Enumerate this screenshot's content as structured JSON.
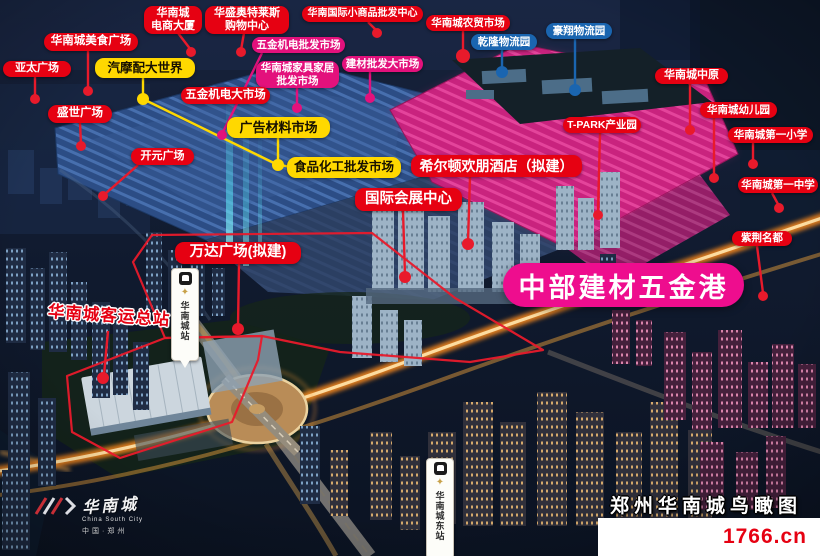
{
  "meta": {
    "title": "郑州华南城鸟瞰图",
    "site": "1766.cn"
  },
  "banner": {
    "text": "中部建材五金港"
  },
  "logo": {
    "name": "华南城",
    "english": "China South City",
    "location": "中国·郑州"
  },
  "icons": {
    "compass": "✦"
  },
  "palette": {
    "red": "#e60112",
    "line_red": "#e81a2b",
    "yellow": "#ffd800",
    "blue": "#1a65b0",
    "pink": "#e3117c",
    "magenta": "#ee0d8e"
  },
  "map": {
    "labels": [
      {
        "id": "ecommerce-tower",
        "lines": [
          "华南城",
          "电商大厦"
        ],
        "color": "red",
        "x": 144,
        "y": 6,
        "w": 58,
        "h": 28,
        "fs": 11,
        "line": "178,33 191,50",
        "dot": [
          191,
          52,
          5
        ]
      },
      {
        "id": "huasheng-outlets",
        "lines": [
          "华盛奥特莱斯",
          "购物中心"
        ],
        "color": "red",
        "x": 205,
        "y": 6,
        "w": 84,
        "h": 28,
        "fs": 11,
        "line": "244,33 241,50",
        "dot": [
          241,
          52,
          5
        ]
      },
      {
        "id": "small-commodity-center",
        "lines": [
          "华南国际小商品批发中心"
        ],
        "color": "red",
        "x": 302,
        "y": 6,
        "w": 121,
        "h": 16,
        "fs": 10,
        "line": "368,22 377,31",
        "dot": [
          377,
          33,
          5
        ]
      },
      {
        "id": "farm-market",
        "lines": [
          "华南城农贸市场"
        ],
        "color": "red",
        "x": 426,
        "y": 15,
        "w": 84,
        "h": 16,
        "fs": 10.5,
        "line": "463,31 463,53",
        "dot": [
          463,
          56,
          7
        ]
      },
      {
        "id": "haoxiang-logistics",
        "lines": [
          "豪翔物流园"
        ],
        "color": "blue",
        "x": 546,
        "y": 23,
        "w": 66,
        "h": 16,
        "fs": 10.5,
        "line": "575,39 575,87",
        "dot": [
          575,
          90,
          6
        ]
      },
      {
        "id": "food-plaza",
        "lines": [
          "华南城美食广场"
        ],
        "color": "red",
        "x": 44,
        "y": 33,
        "w": 94,
        "h": 18,
        "fs": 11.5,
        "line": "88,51 88,89",
        "dot": [
          88,
          91,
          5
        ]
      },
      {
        "id": "qianlong-logistics",
        "lines": [
          "乾隆物流园"
        ],
        "color": "blue",
        "x": 471,
        "y": 34,
        "w": 66,
        "h": 16,
        "fs": 10.5,
        "line": "502,50 502,69",
        "dot": [
          502,
          72,
          6
        ]
      },
      {
        "id": "hardware-wholesale",
        "lines": [
          "五金机电批发市场"
        ],
        "color": "pink",
        "x": 252,
        "y": 37,
        "w": 93,
        "h": 16,
        "fs": 10.5,
        "line": "262,53 223,132",
        "dot": [
          222,
          135,
          5
        ]
      },
      {
        "id": "yatai-plaza",
        "lines": [
          "亚太广场"
        ],
        "color": "red",
        "x": 3,
        "y": 61,
        "w": 68,
        "h": 16,
        "fs": 11,
        "line": "35,77 35,97",
        "dot": [
          35,
          99,
          5
        ]
      },
      {
        "id": "auto-parts-world",
        "lines": [
          "汽摩配大世界"
        ],
        "color": "yellow",
        "x": 95,
        "y": 58,
        "w": 100,
        "h": 20,
        "fs": 12.5,
        "line": "143,78 143,97",
        "dot": [
          143,
          99,
          6
        ]
      },
      {
        "id": "building-materials-market",
        "lines": [
          "建材批发大市场"
        ],
        "color": "pink",
        "x": 342,
        "y": 56,
        "w": 81,
        "h": 16,
        "fs": 10.5,
        "line": "370,72 370,96",
        "dot": [
          370,
          98,
          5
        ]
      },
      {
        "id": "furniture-market",
        "lines": [
          "华南城家具家居",
          "批发市场"
        ],
        "color": "pink",
        "x": 256,
        "y": 61,
        "w": 83,
        "h": 27,
        "fs": 10.5,
        "line": "297,88 297,106",
        "dot": [
          297,
          108,
          5
        ]
      },
      {
        "id": "csc-zhongyuan",
        "lines": [
          "华南城中原"
        ],
        "color": "red",
        "x": 655,
        "y": 68,
        "w": 73,
        "h": 16,
        "fs": 11,
        "line": "690,84 690,128",
        "dot": [
          690,
          130,
          5
        ]
      },
      {
        "id": "hardware-big-market",
        "lines": [
          "五金机电大市场"
        ],
        "color": "red",
        "x": 181,
        "y": 87,
        "w": 89,
        "h": 17,
        "fs": 11.5
      },
      {
        "id": "shengshi-plaza",
        "lines": [
          "盛世广场"
        ],
        "color": "red",
        "x": 48,
        "y": 105,
        "w": 64,
        "h": 18,
        "fs": 11.5,
        "line": "80,123 81,144",
        "dot": [
          81,
          146,
          5
        ]
      },
      {
        "id": "kindergarten",
        "lines": [
          "华南城幼儿园"
        ],
        "color": "red",
        "x": 700,
        "y": 102,
        "w": 77,
        "h": 16,
        "fs": 10.5,
        "line": "714,118 714,176",
        "dot": [
          714,
          178,
          5
        ]
      },
      {
        "id": "ad-materials-market",
        "lines": [
          "广告材料市场"
        ],
        "color": "yellow",
        "x": 227,
        "y": 117,
        "w": 103,
        "h": 21,
        "fs": 13,
        "line": "278,138 278,162",
        "dot": [
          278,
          165,
          6
        ]
      },
      {
        "id": "t-park",
        "lines": [
          "T-PARK产业园"
        ],
        "color": "red",
        "x": 563,
        "y": 117,
        "w": 78,
        "h": 16,
        "fs": 10.5,
        "line": "600,133 598,213",
        "dot": [
          598,
          215,
          5
        ]
      },
      {
        "id": "first-primary-school",
        "lines": [
          "华南城第一小学"
        ],
        "color": "red",
        "x": 728,
        "y": 127,
        "w": 85,
        "h": 16,
        "fs": 10.5,
        "line": "753,143 753,162",
        "dot": [
          753,
          164,
          5
        ]
      },
      {
        "id": "kaiyuan-plaza",
        "lines": [
          "开元广场"
        ],
        "color": "red",
        "x": 131,
        "y": 148,
        "w": 63,
        "h": 17,
        "fs": 11,
        "line": "138,165 105,194",
        "dot": [
          103,
          196,
          5
        ]
      },
      {
        "id": "food-chemical-market",
        "lines": [
          "食品化工批发市场"
        ],
        "color": "yellow",
        "x": 287,
        "y": 157,
        "w": 114,
        "h": 21,
        "fs": 12.5,
        "line": "290,167 281,165"
      },
      {
        "id": "hilton-hampton-hotel",
        "lines": [
          "希尔顿欢朋酒店（拟建）"
        ],
        "color": "red",
        "x": 411,
        "y": 155,
        "w": 171,
        "h": 22,
        "fs": 14,
        "line": "470,177 468,242",
        "dot": [
          468,
          244,
          6
        ]
      },
      {
        "id": "first-middle-school",
        "lines": [
          "华南城第一中学"
        ],
        "color": "red",
        "x": 738,
        "y": 177,
        "w": 80,
        "h": 16,
        "fs": 10.5,
        "line": "772,193 779,206",
        "dot": [
          779,
          208,
          5
        ]
      },
      {
        "id": "convention-center",
        "lines": [
          "国际会展中心"
        ],
        "color": "red",
        "x": 355,
        "y": 188,
        "w": 107,
        "h": 23,
        "fs": 14.5,
        "line": "403,211 405,275",
        "dot": [
          405,
          277,
          6
        ]
      },
      {
        "id": "zijin-mingdu",
        "lines": [
          "紫荆名都"
        ],
        "color": "red",
        "x": 732,
        "y": 231,
        "w": 60,
        "h": 15,
        "fs": 10.5,
        "line": "757,246 763,293",
        "dot": [
          763,
          296,
          5
        ]
      },
      {
        "id": "wanda-plaza",
        "lines": [
          "万达广场(拟建)"
        ],
        "color": "red",
        "x": 175,
        "y": 242,
        "w": 126,
        "h": 22,
        "fs": 14.5,
        "line": "239,264 238,327",
        "dot": [
          238,
          329,
          6
        ]
      },
      {
        "id": "bus-terminal",
        "lines": [
          "华南城客运总站"
        ],
        "color": "red",
        "style": "outline",
        "x": 48,
        "y": 305,
        "w": 122,
        "h": 24,
        "fs": 16.5,
        "rot": 4,
        "line": "108,331 104,375",
        "dot": [
          103,
          378,
          6
        ]
      }
    ],
    "extra_lines": [
      {
        "color": "yellow",
        "points": "143,99 278,165"
      }
    ],
    "boundaries": [
      {
        "points": "67,376 165,338 262,336 258,360 232,422 120,458 72,432"
      },
      {
        "points": "165,338 133,262 152,235 372,233 455,298 543,350 470,362 340,352 262,336"
      }
    ],
    "stations": [
      {
        "id": "huanancheng",
        "text": "华南城站",
        "x": 171,
        "y": 268,
        "h": 84
      },
      {
        "id": "huanancheng-east",
        "text": "华南城东站",
        "x": 426,
        "y": 458,
        "h": 92
      }
    ]
  }
}
